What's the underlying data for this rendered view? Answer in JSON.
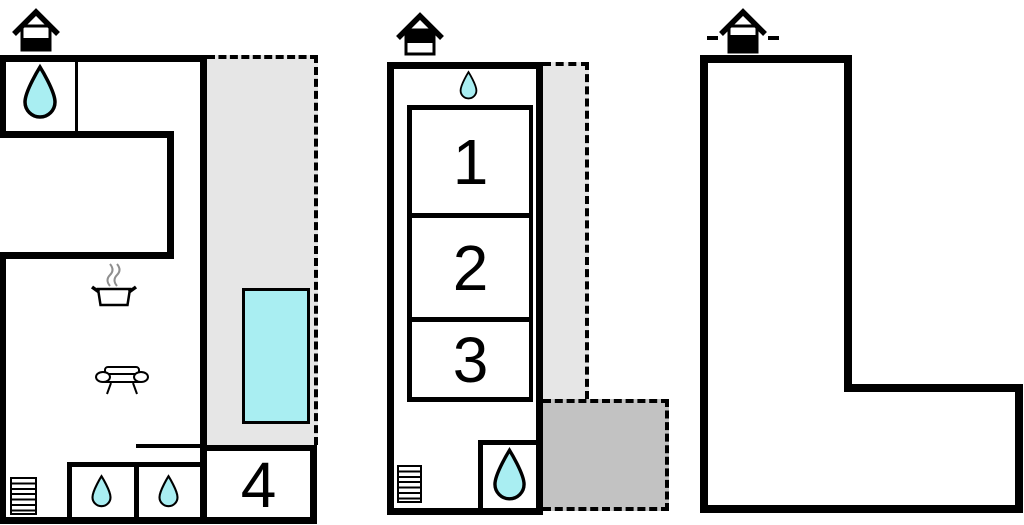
{
  "figure_type": "vacation-home floor plan (3 panels: ground floor, upper floor, site outline)",
  "colors": {
    "wall": "#000000",
    "pool_fill": "#a9eef2",
    "water_drop_fill": "#a9eef2",
    "terrace_light": "#e6e6e6",
    "terrace_dark": "#c2c2c2",
    "background": "#ffffff",
    "steam_gray": "#8f8f8f"
  },
  "ground_floor": {
    "level_icon": "house-ground-floor-icon",
    "room_labels": {
      "r4": "4"
    },
    "features": [
      "water-drop-icon (bathroom top-left)",
      "cooking-pot-icon (kitchen)",
      "sofa-icon (living room)",
      "stairs-icon",
      "water-drop-icon (shower room left)",
      "water-drop-icon (shower room right)",
      "pool (cyan) on gray terrace with dashed boundary",
      "room 4 bottom-right"
    ]
  },
  "upper_floor": {
    "level_icon": "house-upper-floor-icon",
    "room_labels": {
      "r1": "1",
      "r2": "2",
      "r3": "3"
    },
    "features": [
      "water-drop-icon (top entrance)",
      "stairs-icon",
      "water-drop-icon (bottom shower room)",
      "light-gray balcony strip with dashed boundary",
      "dark-gray terrace with dashed boundary"
    ]
  },
  "site_plan": {
    "level_icon": "house-site-icon",
    "room_labels": {},
    "features": [
      "empty L-shaped plot outline"
    ]
  },
  "icons": {
    "water-drop-icon": "teardrop, cyan fill, black outline",
    "cooking-pot-icon": "pot with handles and two steam squiggles",
    "sofa-icon": "sofa seen from front with oval armrests",
    "stairs-icon": "ladder-style striped rectangle",
    "house-ground-floor-icon": "roof over square, lower half black",
    "house-upper-floor-icon": "roof over square, upper half black",
    "house-site-icon": "roof over square, lower part black, ground dashes at sides"
  }
}
